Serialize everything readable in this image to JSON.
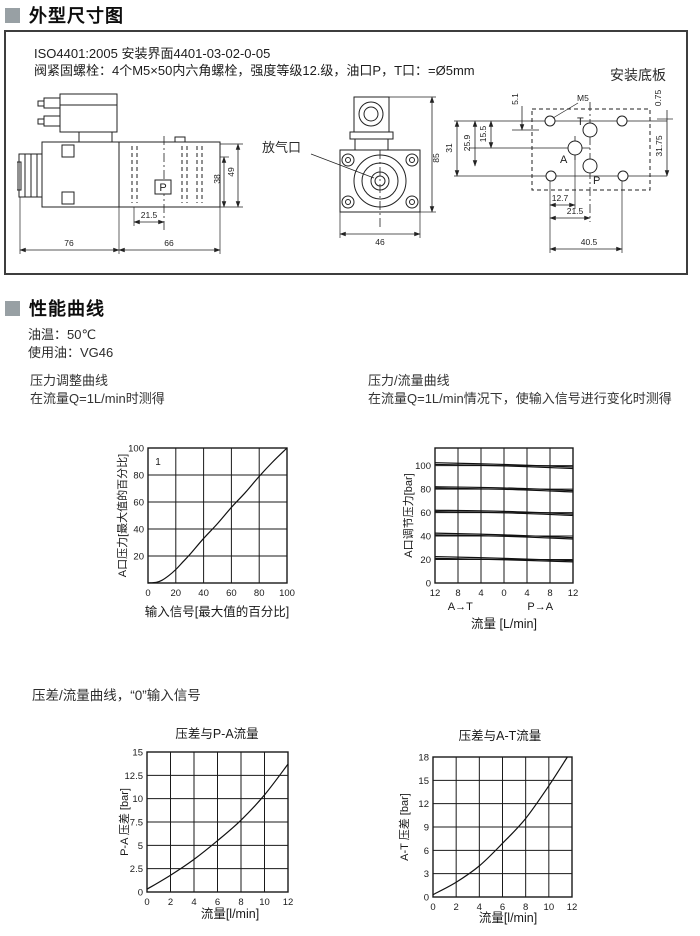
{
  "sections": {
    "header1": "外型尺寸图",
    "header2": "性能曲线",
    "section3": "压差/流量曲线，“0”输入信号"
  },
  "dimension_box": {
    "line1": "ISO4401:2005   安装界面4401-03-02-0-05",
    "line2": "阀紧固螺栓：4个M5×50内六角螺栓，强度等级12.级，油口P，T口：=Ø5mm"
  },
  "drawings": {
    "mounting_plate_label": "安装底板",
    "air_vent_label": "放气口",
    "side": {
      "d76": "76",
      "d66": "66",
      "d215": "21.5",
      "d38": "38",
      "d49": "49",
      "port": "P"
    },
    "front": {
      "d85": "85",
      "d46": "46"
    },
    "plate": {
      "m5": "M5",
      "t": "T",
      "a": "A",
      "p": "P",
      "d51": "5.1",
      "d259": "25.9",
      "d31": "31",
      "d155": "15.5",
      "d075": "0.75",
      "d3175": "31.75",
      "d127": "12.7",
      "d215": "21.5",
      "d405": "40.5"
    }
  },
  "performance": {
    "oil_temp": "油温：50℃",
    "oil_type": "使用油：VG46",
    "c1_title": "压力调整曲线",
    "c1_sub": "在流量Q=1L/min时测得",
    "c2_title": "压力/流量曲线",
    "c2_sub": "在流量Q=1L/min情况下，使输入信号进行变化时测得"
  },
  "chart_data": [
    {
      "type": "line",
      "name": "pressure-adjustment-curve",
      "title": "",
      "xlabel": "输入信号[最大值的百分比]",
      "ylabel": "A口压力[最大值的百分比]",
      "xlim": [
        0,
        100
      ],
      "ylim": [
        0,
        100
      ],
      "xticks": [
        0,
        20,
        40,
        60,
        80,
        100
      ],
      "xtick_labels": [
        "0",
        "20",
        "40",
        "60",
        "80",
        "100"
      ],
      "yticks": [
        0,
        20,
        40,
        60,
        80,
        100
      ],
      "ytick_labels": [
        "",
        "20",
        "40",
        "60",
        "80",
        "100"
      ],
      "annotation": "1",
      "grid": true,
      "series": [
        {
          "name": "curve-1",
          "x": [
            0,
            6,
            10,
            15,
            20,
            25,
            30,
            40,
            50,
            60,
            70,
            80,
            90,
            100
          ],
          "y": [
            0,
            0.5,
            2,
            5.5,
            10,
            15.5,
            21,
            33,
            44,
            56,
            67,
            79,
            90,
            100
          ]
        }
      ]
    },
    {
      "type": "line",
      "name": "pressure-flow-curve",
      "title": "",
      "xlabel": "流量 [L/min]",
      "ylabel": "A口调节压力[bar]",
      "xlim": [
        -12,
        12
      ],
      "ylim": [
        0,
        115
      ],
      "xticks": [
        -12,
        -8,
        -4,
        0,
        4,
        8,
        12
      ],
      "xtick_labels": [
        "12",
        "8",
        "4",
        "0",
        "4",
        "8",
        "12"
      ],
      "yticks": [
        0,
        20,
        40,
        60,
        80,
        100
      ],
      "ytick_labels": [
        "0",
        "20",
        "40",
        "60",
        "80",
        "100"
      ],
      "zone_labels": [
        {
          "text": "A→T",
          "x": -7.6
        },
        {
          "text": "P→A",
          "x": 6.3
        }
      ],
      "grid": true,
      "series": [
        {
          "name": "100bar-a",
          "x": [
            -12,
            0,
            12
          ],
          "y": [
            102.5,
            101,
            98.8
          ]
        },
        {
          "name": "100bar-b",
          "x": [
            -12,
            0,
            12
          ],
          "y": [
            101,
            99.8,
            97.5
          ]
        },
        {
          "name": "80bar-a",
          "x": [
            -12,
            0,
            12
          ],
          "y": [
            82,
            81,
            78.8
          ]
        },
        {
          "name": "80bar-b",
          "x": [
            -12,
            0,
            12
          ],
          "y": [
            80.8,
            79.8,
            77.6
          ]
        },
        {
          "name": "60bar-a",
          "x": [
            -12,
            0,
            12
          ],
          "y": [
            62,
            61,
            58.8
          ]
        },
        {
          "name": "60bar-b",
          "x": [
            -12,
            0,
            12
          ],
          "y": [
            60.8,
            59.8,
            57.6
          ]
        },
        {
          "name": "40bar-a",
          "x": [
            -12,
            0,
            12
          ],
          "y": [
            42.5,
            41,
            38.6
          ]
        },
        {
          "name": "40bar-b",
          "x": [
            -12,
            0,
            12
          ],
          "y": [
            41,
            39.8,
            37.5
          ]
        },
        {
          "name": "20bar-a",
          "x": [
            -12,
            0,
            12
          ],
          "y": [
            22.5,
            21,
            19
          ]
        },
        {
          "name": "20bar-b",
          "x": [
            -12,
            0,
            12
          ],
          "y": [
            21,
            19.8,
            18
          ]
        }
      ]
    },
    {
      "type": "line",
      "name": "dp-vs-pa-flow",
      "title": "压差与P-A流量",
      "xlabel": "流量[l/min]",
      "ylabel": "P-A 压差 [bar]",
      "xlim": [
        0,
        12
      ],
      "ylim": [
        0,
        15
      ],
      "xticks": [
        0,
        2,
        4,
        6,
        8,
        10,
        12
      ],
      "xtick_labels": [
        "0",
        "2",
        "4",
        "6",
        "8",
        "10",
        "12"
      ],
      "yticks": [
        0,
        2.5,
        5,
        7.5,
        10,
        12.5,
        15
      ],
      "ytick_labels": [
        "0",
        "2.5",
        "5",
        "7.5",
        "10",
        "12.5",
        "15"
      ],
      "grid": true,
      "series": [
        {
          "name": "curve",
          "x": [
            0,
            2,
            4,
            6,
            8,
            10,
            12
          ],
          "y": [
            0.3,
            1.8,
            3.5,
            5.5,
            7.7,
            10.4,
            13.7
          ]
        }
      ]
    },
    {
      "type": "line",
      "name": "dp-vs-at-flow",
      "title": "压差与A-T流量",
      "xlabel": "流量[l/min]",
      "ylabel": "A-T 压差 [bar]",
      "xlim": [
        0,
        12
      ],
      "ylim": [
        0,
        18
      ],
      "xticks": [
        0,
        2,
        4,
        6,
        8,
        10,
        12
      ],
      "xtick_labels": [
        "0",
        "2",
        "4",
        "6",
        "8",
        "10",
        "12"
      ],
      "yticks": [
        0,
        3,
        6,
        9,
        12,
        15,
        18
      ],
      "ytick_labels": [
        "0",
        "3",
        "6",
        "9",
        "12",
        "15",
        "18"
      ],
      "grid": true,
      "series": [
        {
          "name": "curve",
          "x": [
            0,
            2,
            4,
            6,
            8,
            10,
            11.6
          ],
          "y": [
            0.3,
            1.9,
            4,
            6.9,
            10.1,
            14.3,
            18
          ]
        }
      ]
    }
  ]
}
